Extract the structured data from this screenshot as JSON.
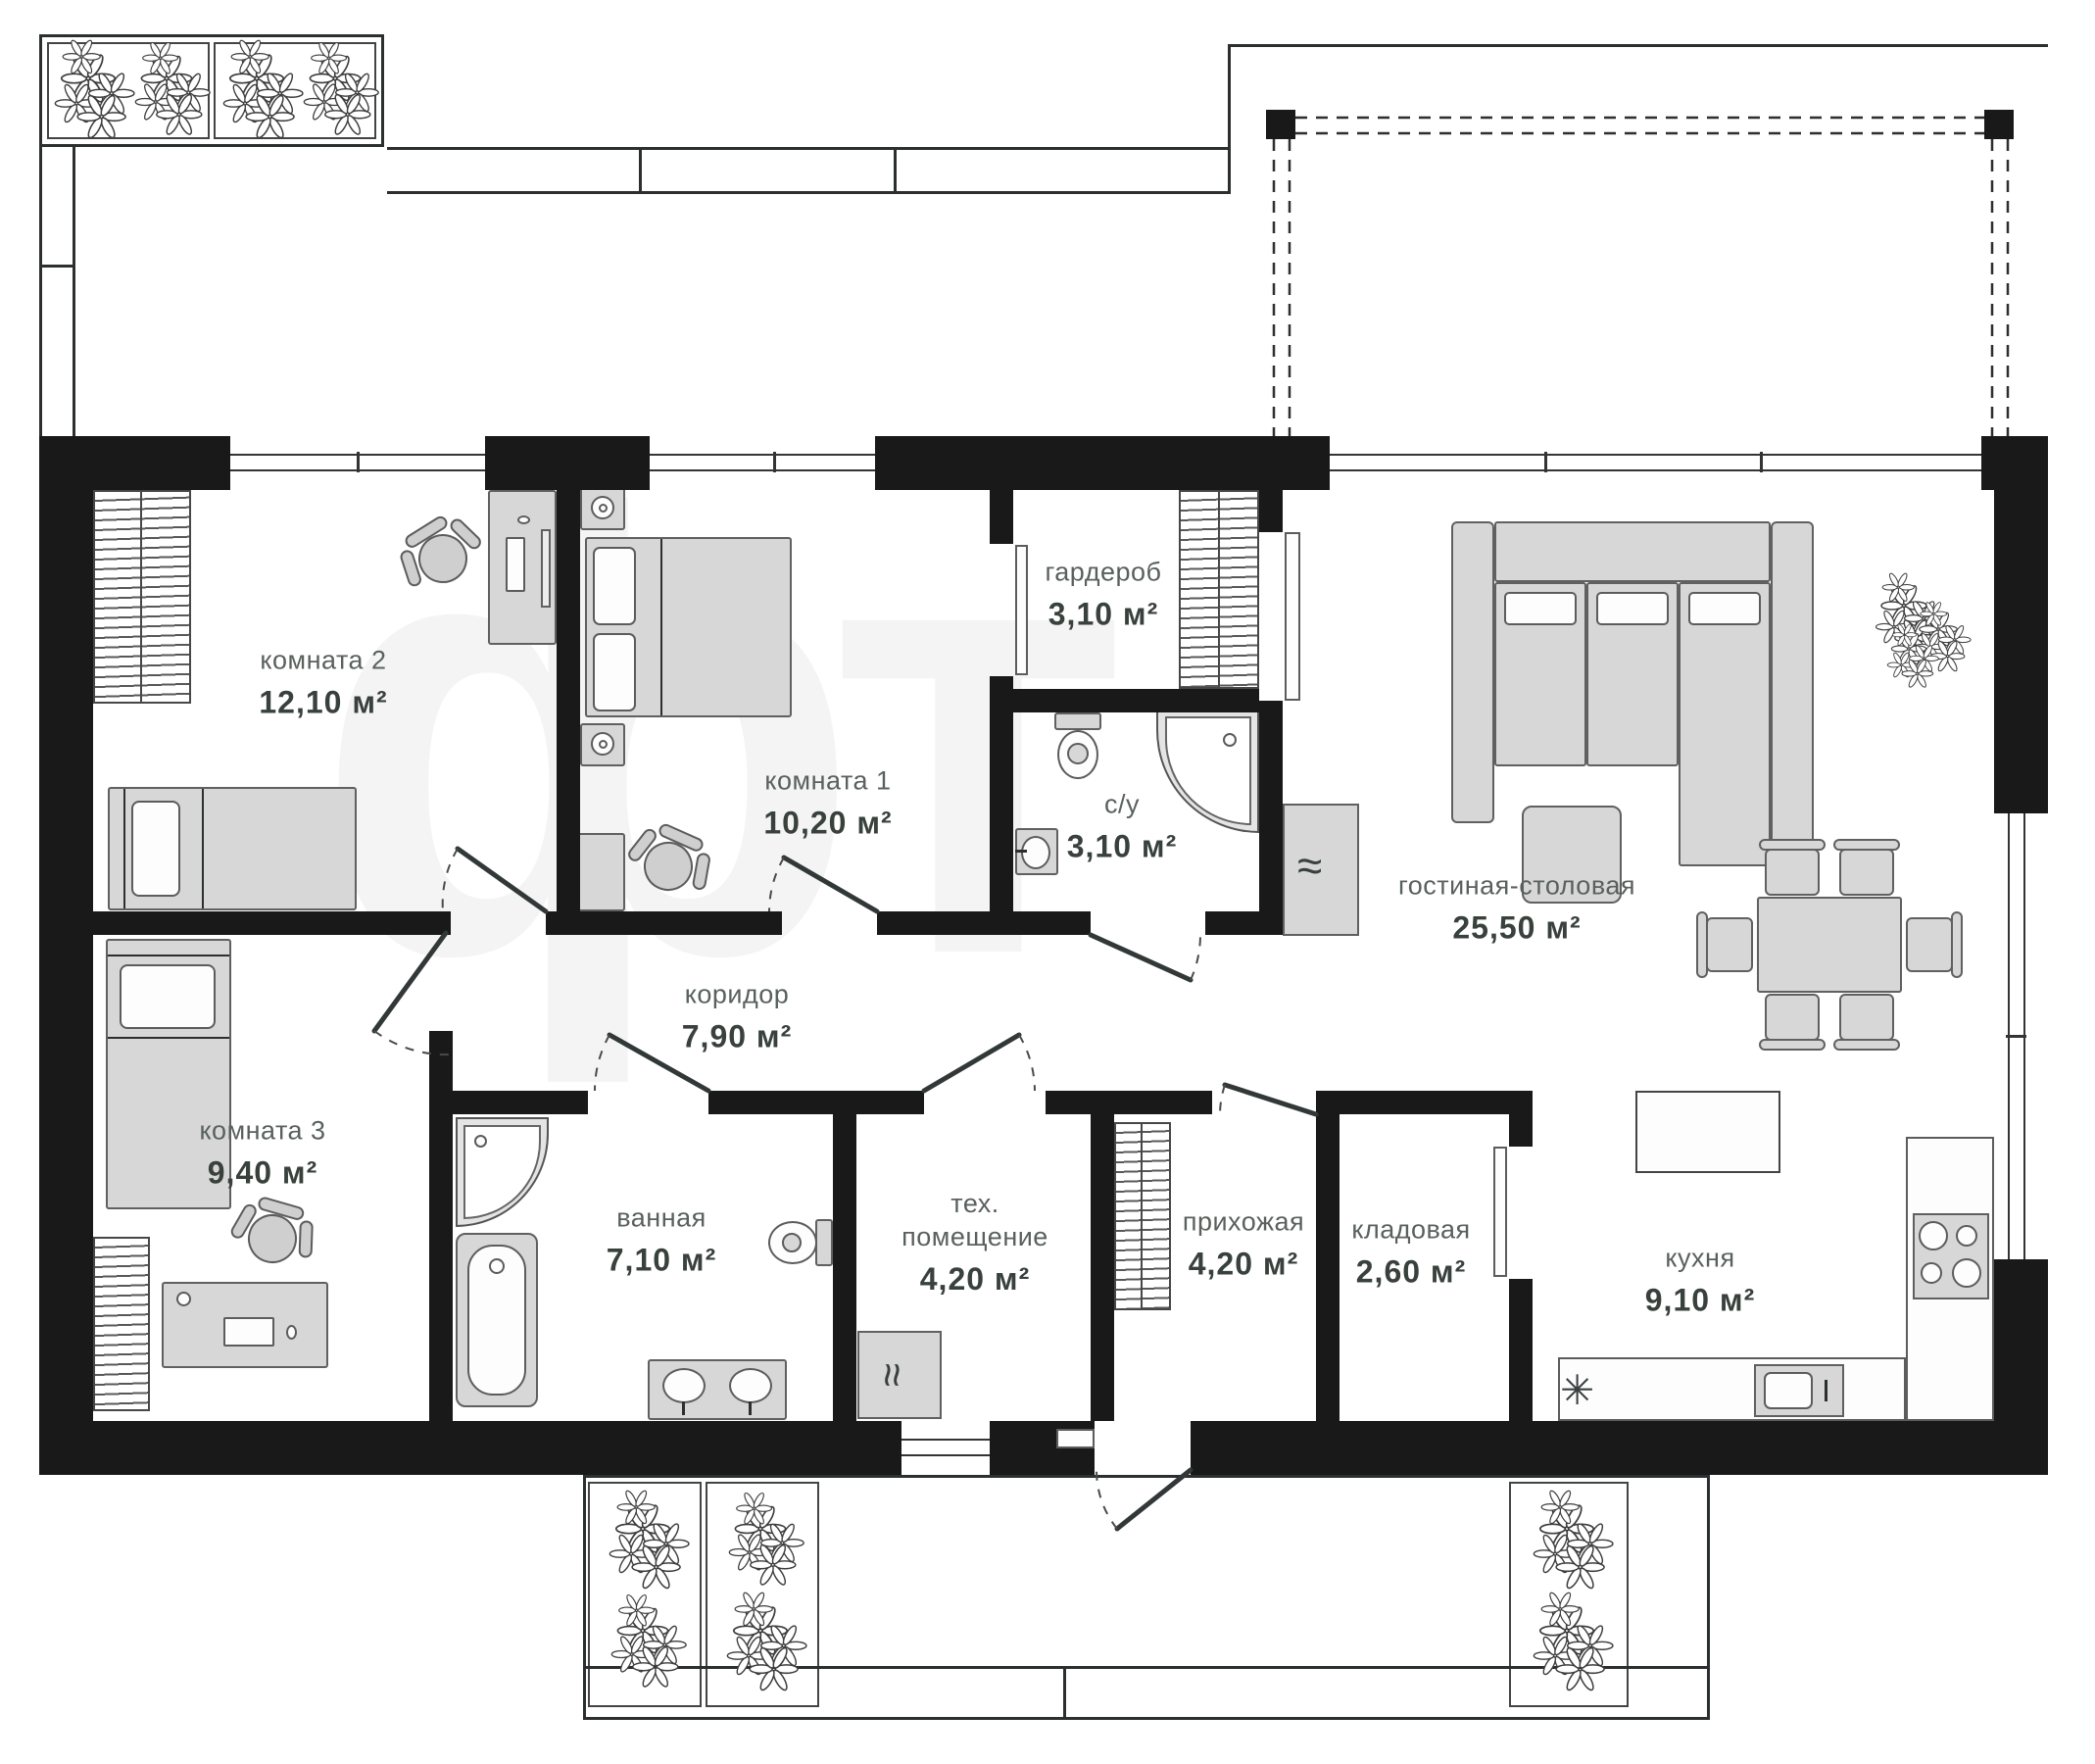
{
  "plan": {
    "watermark": "фт",
    "rooms": [
      {
        "name": "комната 2",
        "area": "12,10 м²"
      },
      {
        "name": "комната 1",
        "area": "10,20 м²"
      },
      {
        "name": "гардероб",
        "area": "3,10 м²"
      },
      {
        "name": "с/у",
        "area": "3,10 м²"
      },
      {
        "name": "гостиная-столовая",
        "area": "25,50 м²"
      },
      {
        "name": "комната 3",
        "area": "9,40 м²"
      },
      {
        "name": "коридор",
        "area": "7,90 м²"
      },
      {
        "name": "ванная",
        "area": "7,10 м²"
      },
      {
        "name": "тех. помещение",
        "area": "4,20 м²"
      },
      {
        "name": "прихожая",
        "area": "4,20 м²"
      },
      {
        "name": "кладовая",
        "area": "2,60 м²"
      },
      {
        "name": "кухня",
        "area": "9,10 м²"
      }
    ],
    "symbols": {
      "boiler": "≈",
      "heater": "≈",
      "fridge": "✳"
    },
    "colors": {
      "wall": "#191919",
      "furniture_fill": "#d7d7d7",
      "furniture_stroke": "#606060",
      "label": "#59615d",
      "area_label": "#39413d"
    }
  }
}
